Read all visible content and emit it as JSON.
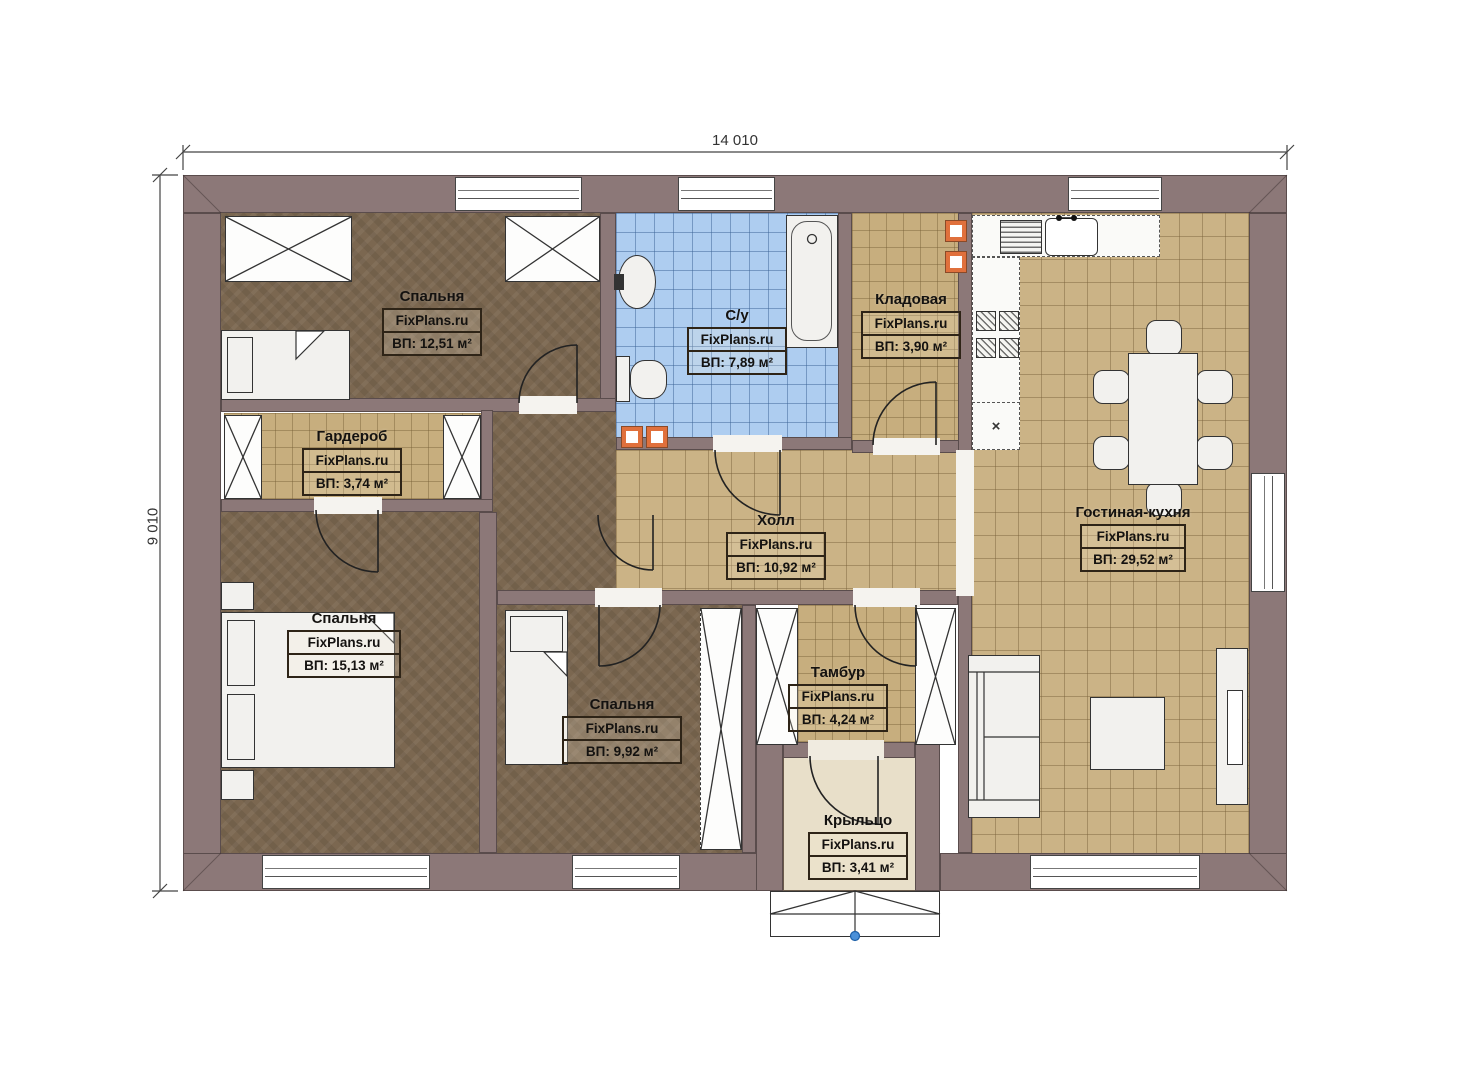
{
  "dimensions": {
    "width_label": "14 010",
    "height_label": "9 010"
  },
  "rooms": [
    {
      "id": "bedroom-top-left",
      "name": "Спальня",
      "watermark": "FixPlans.ru",
      "area": "ВП: 12,51 м²"
    },
    {
      "id": "bathroom",
      "name": "С/у",
      "watermark": "FixPlans.ru",
      "area": "ВП: 7,89 м²"
    },
    {
      "id": "storage",
      "name": "Кладовая",
      "watermark": "FixPlans.ru",
      "area": "ВП: 3,90 м²"
    },
    {
      "id": "living-kitchen",
      "name": "Гостиная-кухня",
      "watermark": "FixPlans.ru",
      "area": "ВП: 29,52 м²"
    },
    {
      "id": "wardrobe",
      "name": "Гардероб",
      "watermark": "FixPlans.ru",
      "area": "ВП: 3,74 м²"
    },
    {
      "id": "hall",
      "name": "Холл",
      "watermark": "FixPlans.ru",
      "area": "ВП: 10,92 м²"
    },
    {
      "id": "bedroom-bottom-left",
      "name": "Спальня",
      "watermark": "FixPlans.ru",
      "area": "ВП: 15,13 м²"
    },
    {
      "id": "bedroom-bottom-mid",
      "name": "Спальня",
      "watermark": "FixPlans.ru",
      "area": "ВП: 9,92 м²"
    },
    {
      "id": "vestibule",
      "name": "Тамбур",
      "watermark": "FixPlans.ru",
      "area": "ВП: 4,24 м²"
    },
    {
      "id": "porch",
      "name": "Крыльцо",
      "watermark": "FixPlans.ru",
      "area": "ВП: 3,41 м²"
    }
  ],
  "symbols": {
    "cabinet_cross": "×"
  },
  "colors": {
    "wall": "#8c7878",
    "floor_wood": "#7b6750",
    "tile_beige": "#cbb386",
    "tile_blue": "#aecdf0",
    "porch": "#e8dfc9",
    "vent_orange": "#e0703c",
    "marker_blue": "#4a90d9"
  }
}
